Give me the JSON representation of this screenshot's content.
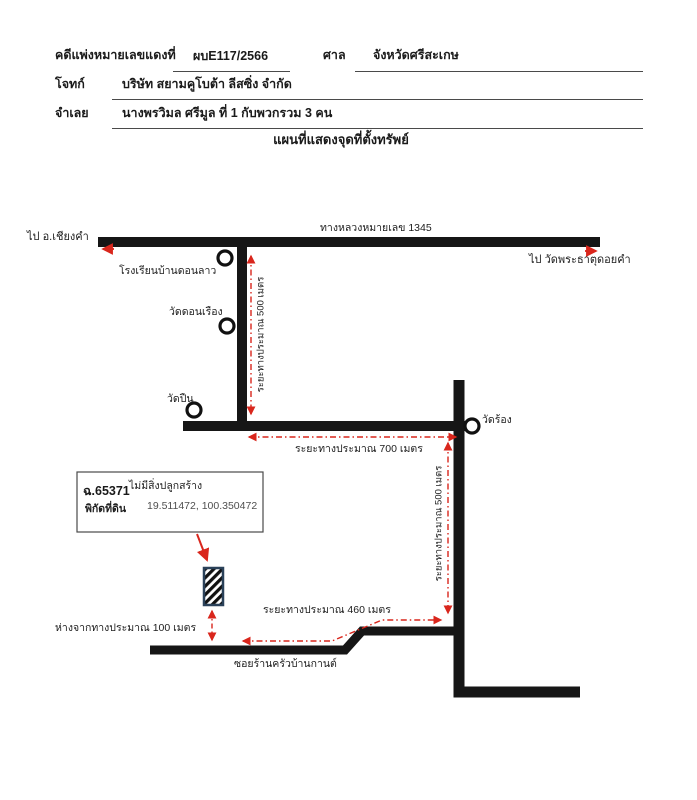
{
  "header": {
    "case_label": "คดีแพ่งหมายเลขแดงที่",
    "case_no": "ผบE117/2566",
    "court_label": "ศาล",
    "court_name": "จังหวัดศรีสะเกษ",
    "plaintiff_label": "โจทก์",
    "plaintiff_name": "บริษัท สยามคูโบต้า ลีสซิ่ง จำกัด",
    "defendant_label": "จำเลย",
    "defendant_name": "นางพรวิมล ศรีมูล ที่ 1 กับพวกรวม 3 คน",
    "map_title": "แผนที่แสดงจุดที่ตั้งทรัพย์"
  },
  "map": {
    "highway_label": "ทางหลวงหมายเลข 1345",
    "dest_left": "ไป อ.เชียงคำ",
    "dest_right": "ไป วัดพระธาตุดอยคำ",
    "school_label": "โรงเรียนบ้านดอนลาว",
    "wat_don_rueang_label": "วัดดอนเรือง",
    "wat_pin_label": "วัดปืน",
    "wat_rong_label": "วัดร้อง",
    "dist_left_500": "ระยะทางประมาณ 500 เมตร",
    "dist_700": "ระยะทางประมาณ 700 เมตร",
    "dist_right_500": "ระยะทางประมาณ 500 เมตร",
    "dist_460": "ระยะทางประมาณ 460 เมตร",
    "dist_100": "ห่างจากทางประมาณ 100 เมตร",
    "soi_label": "ซอยร้านครัวบ้านกานต์",
    "parcel": {
      "deed_no": "ฉ.65371",
      "note": "ไม่มีสิ่งปลูกสร้าง",
      "coord_label": "พิกัดที่ดิน",
      "coords": "19.511472, 100.350472"
    },
    "colors": {
      "road": "#161616",
      "accent_red": "#d9261c",
      "hatch_border": "#2a4159"
    }
  }
}
